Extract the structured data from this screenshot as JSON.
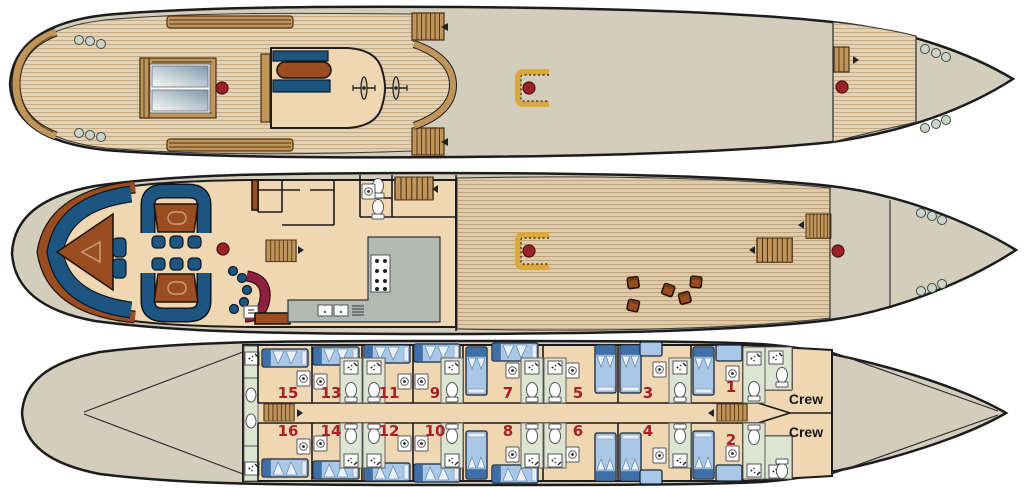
{
  "cabins": {
    "top_row_numbers": [
      "15",
      "13",
      "11",
      "9",
      "7",
      "5",
      "3",
      "1"
    ],
    "bottom_row_numbers": [
      "16",
      "14",
      "12",
      "10",
      "8",
      "6",
      "4",
      "2"
    ],
    "crew_labels": [
      "Crew",
      "Crew"
    ],
    "number_color": "#a82025"
  },
  "icons": {
    "stairs": "stairs-icon",
    "ladder": "ladder-icon",
    "toilet": "toilet-icon",
    "shower": "shower-icon",
    "washbasin": "washbasin-icon",
    "stove": "stove-burners-icon",
    "sink": "kitchen-sink-icon",
    "helm": "helm-wheel-icon",
    "skylight": "skylight-icon",
    "deck_fitting": "deck-fitting-icon",
    "pillar": "pillar-icon"
  },
  "colors": {
    "hull_fill": "#d3cdbb",
    "outline": "#1c1c1c",
    "plank_light": "#e4d2b4",
    "plank_line": "#c7aa81",
    "plank_aft": "#dfcaa9",
    "plank_aft_line": "#c0a37a",
    "wood": "#c0955b",
    "sienna": "#9a4d20",
    "upholstery_blue": "#1c5680",
    "bed_blue": "#a9c8e7",
    "bed_blue_dark": "#3f6fa8",
    "pillow": "#e9f2fb",
    "cream_floor": "#eed7b2",
    "bath_green": "#dde4d2",
    "kitchen_gray": "#b3b8b4",
    "bar_maroon": "#8e2040",
    "accent_red": "#9b2226",
    "number_red": "#a82025",
    "gold": "#d9a93e",
    "fitting_gray": "#ccd3cb"
  }
}
